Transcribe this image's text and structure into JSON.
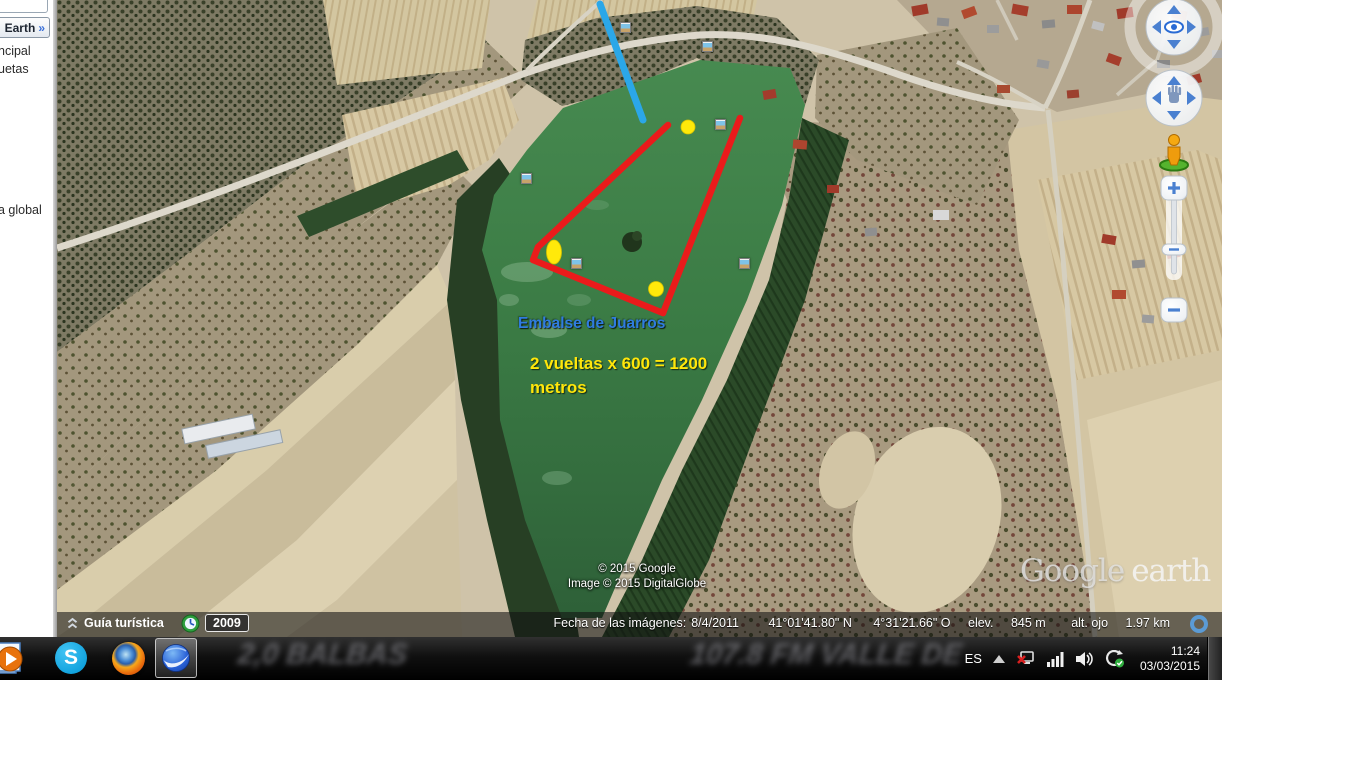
{
  "sidebar": {
    "earth_label": "Earth",
    "earth_chevron": "»",
    "fragment1": "ncipal",
    "fragment2": "uetas",
    "fragment3": "a global"
  },
  "map": {
    "annotations": {
      "reservoir_label": "Embalse de Juarros",
      "note_line1": "2 vueltas x 600 = 1200",
      "note_line2": "metros"
    },
    "copyright": {
      "line1": "© 2015 Google",
      "line2": "Image © 2015 DigitalGlobe"
    },
    "watermark": {
      "google": "Google",
      "earth": "earth"
    },
    "colors": {
      "track_red": "#ea1b1b",
      "placemark_yellow": "#ffe90a",
      "gps_line_blue": "#2ba7e8",
      "label_blue": "#2f7ce0",
      "label_yellow": "#ffe60a"
    }
  },
  "status": {
    "guide": "Guía turística",
    "year": "2009",
    "fecha_label": "Fecha de las imágenes:",
    "fecha": "8/4/2011",
    "lat": "41°01'41.80\" N",
    "lon": "4°31'21.66\" O",
    "elev_label": "elev.",
    "elev": "845 m",
    "alt_label": "alt. ojo",
    "alt": "1.97 km"
  },
  "taskbar": {
    "apps": {
      "skype_letter": "S"
    },
    "wallpaper": {
      "t1": "2,0 BALBAS",
      "t2": "107.8 FM VALLE DE"
    },
    "tray": {
      "language": "ES",
      "time": "11:24",
      "date": "03/03/2015"
    }
  }
}
